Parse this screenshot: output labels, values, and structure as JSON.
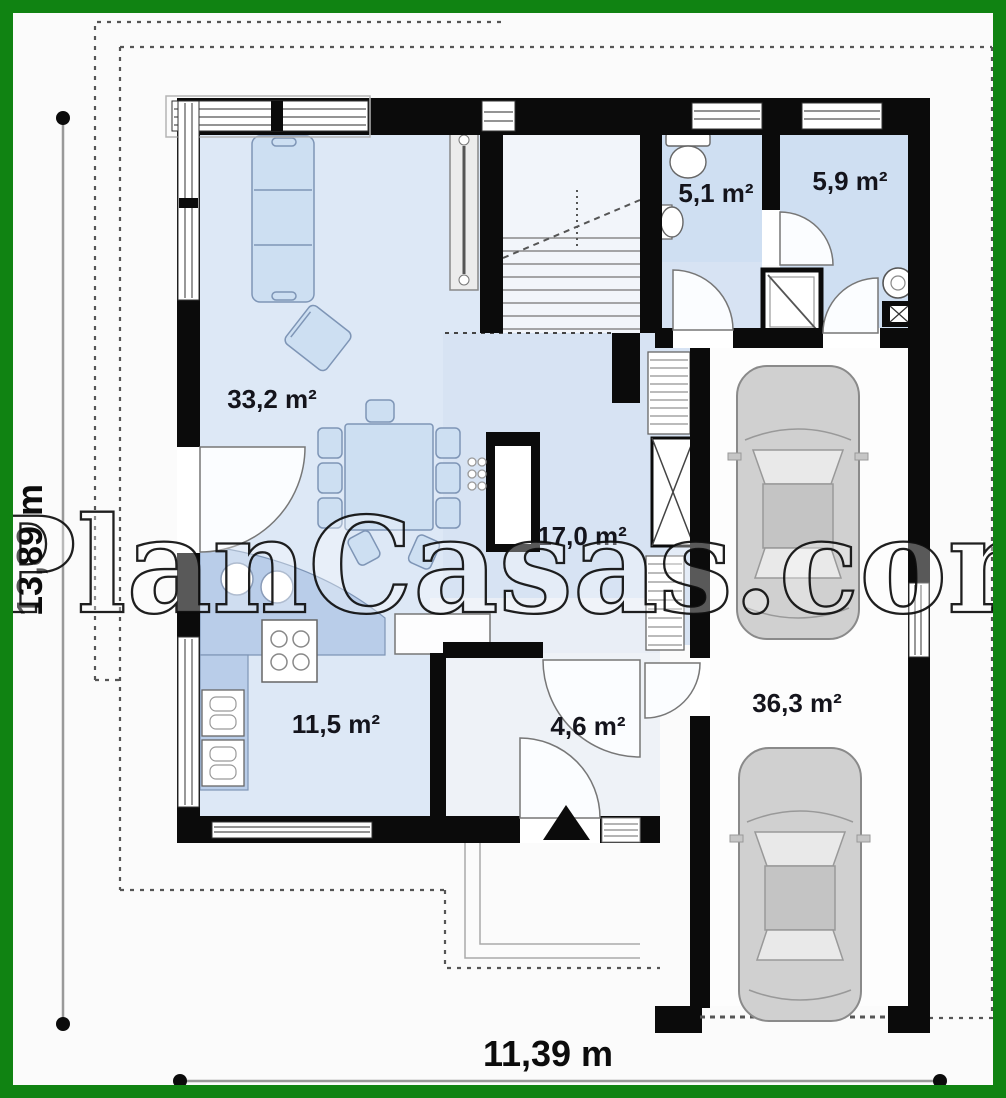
{
  "plan": {
    "watermark": "PlanCasas.com",
    "total_depth_label": "13,89 m",
    "total_width_label": "11,39 m",
    "rooms": {
      "living": "33,2 m²",
      "wc": "5,1 m²",
      "bathroom": "5,9 m²",
      "hall": "17,0 m²",
      "kitchen": "11,5 m²",
      "vestibule": "4,6 m²",
      "garage": "36,3 m²"
    }
  },
  "colors": {
    "border_green": "#108312",
    "wall_black": "#0b0b0b",
    "room_blue": "#dce7f5",
    "furniture_blue": "#c8d8ee",
    "counter_blue": "#b9cde9",
    "car_gray": "#d0d0d0"
  }
}
